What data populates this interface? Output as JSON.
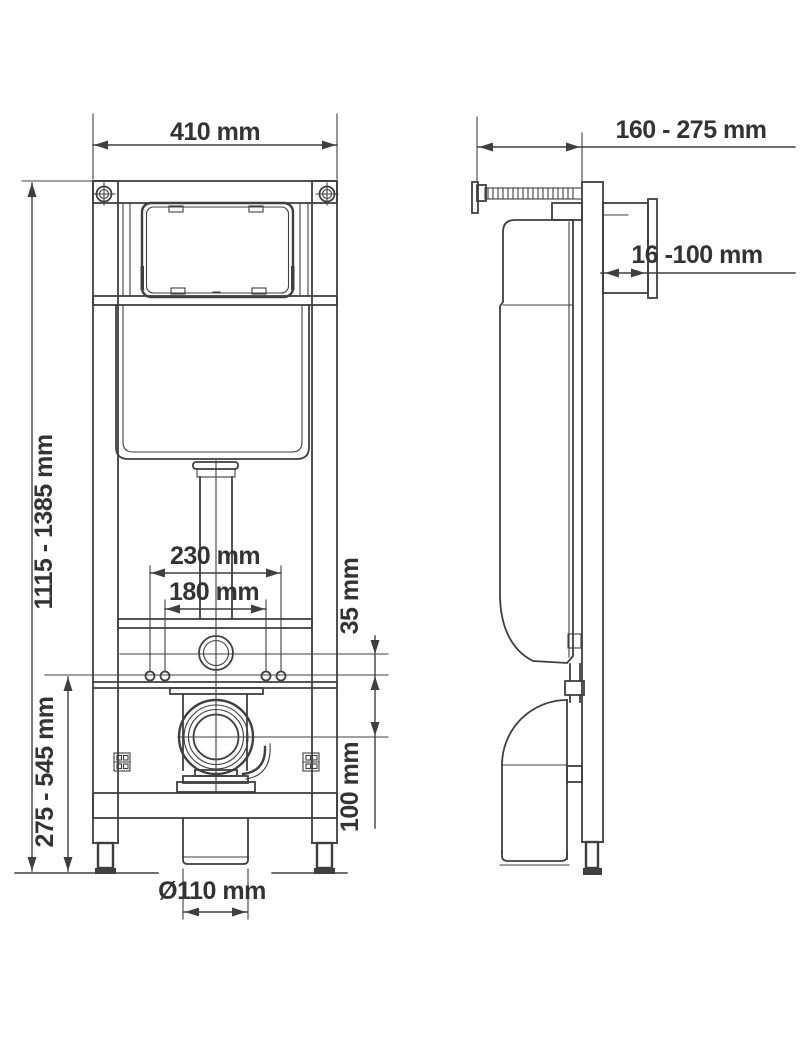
{
  "title": "Concealed WC installation frame technical drawing",
  "views": {
    "front": {
      "dimensions": {
        "frame_width": "410 mm",
        "frame_height": "1115 - 1385 mm",
        "fixing_height": "275 - 545 mm",
        "bolt_spacing_outer": "230 mm",
        "bolt_spacing_inner": "180 mm",
        "outlet_to_bolts": "35 mm",
        "bolts_to_drain": "100 mm",
        "drain_diameter": "Ø110 mm"
      }
    },
    "side": {
      "dimensions": {
        "frame_depth": "160 - 275 mm",
        "flush_shaft_depth": "16 -100 mm"
      }
    }
  },
  "colors": {
    "line": "#3f3f3f",
    "text": "#333333",
    "background": "#ffffff"
  }
}
